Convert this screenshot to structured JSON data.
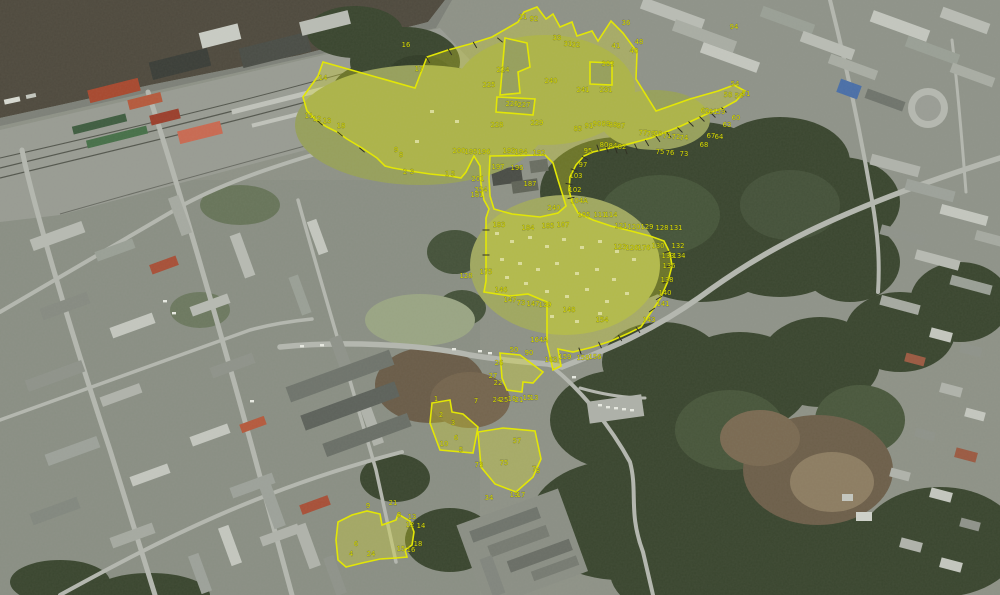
{
  "map": {
    "description": "aerial-cadastral-overlay",
    "colors": {
      "boundary_line": "#e4e800",
      "boundary_fill": "rgba(225,228,30,0.30)",
      "parcel_label": "#d9dd00",
      "river": "#4f4a3e",
      "forest": "#3a462f",
      "urban_base": "#8e9287",
      "road": "#b4b7af",
      "railway_band": "#999c93"
    },
    "parcel_labels": [
      {
        "t": "14",
        "x": 323,
        "y": 80
      },
      {
        "t": "16",
        "x": 406,
        "y": 47
      },
      {
        "t": "17",
        "x": 419,
        "y": 71
      },
      {
        "t": "11",
        "x": 309,
        "y": 118
      },
      {
        "t": "12",
        "x": 317,
        "y": 121
      },
      {
        "t": "13",
        "x": 327,
        "y": 123
      },
      {
        "t": "18",
        "x": 341,
        "y": 128
      },
      {
        "t": "9",
        "x": 396,
        "y": 152
      },
      {
        "t": "8",
        "x": 401,
        "y": 157
      },
      {
        "t": "2",
        "x": 405,
        "y": 174
      },
      {
        "t": "3",
        "x": 412,
        "y": 174
      },
      {
        "t": "1",
        "x": 447,
        "y": 176
      },
      {
        "t": "5",
        "x": 453,
        "y": 176
      },
      {
        "t": "21",
        "x": 523,
        "y": 19
      },
      {
        "t": "92",
        "x": 534,
        "y": 21
      },
      {
        "t": "224",
        "x": 503,
        "y": 72
      },
      {
        "t": "225",
        "x": 489,
        "y": 87
      },
      {
        "t": "226",
        "x": 512,
        "y": 106
      },
      {
        "t": "227",
        "x": 524,
        "y": 107
      },
      {
        "t": "228",
        "x": 497,
        "y": 127
      },
      {
        "t": "229",
        "x": 537,
        "y": 125
      },
      {
        "t": "240",
        "x": 551,
        "y": 83
      },
      {
        "t": "241",
        "x": 583,
        "y": 92
      },
      {
        "t": "231",
        "x": 606,
        "y": 92
      },
      {
        "t": "302",
        "x": 608,
        "y": 66
      },
      {
        "t": "33",
        "x": 557,
        "y": 40
      },
      {
        "t": "31",
        "x": 568,
        "y": 46
      },
      {
        "t": "32",
        "x": 576,
        "y": 47
      },
      {
        "t": "41",
        "x": 616,
        "y": 48
      },
      {
        "t": "40",
        "x": 634,
        "y": 53
      },
      {
        "t": "48",
        "x": 639,
        "y": 44
      },
      {
        "t": "36",
        "x": 626,
        "y": 25
      },
      {
        "t": "94",
        "x": 734,
        "y": 29
      },
      {
        "t": "85",
        "x": 578,
        "y": 131
      },
      {
        "t": "91",
        "x": 589,
        "y": 128
      },
      {
        "t": "90",
        "x": 597,
        "y": 126
      },
      {
        "t": "89",
        "x": 606,
        "y": 126
      },
      {
        "t": "88",
        "x": 613,
        "y": 127
      },
      {
        "t": "87",
        "x": 621,
        "y": 128
      },
      {
        "t": "80",
        "x": 604,
        "y": 147
      },
      {
        "t": "84",
        "x": 613,
        "y": 148
      },
      {
        "t": "82",
        "x": 622,
        "y": 149
      },
      {
        "t": "95",
        "x": 588,
        "y": 153
      },
      {
        "t": "77",
        "x": 643,
        "y": 135
      },
      {
        "t": "79",
        "x": 651,
        "y": 136
      },
      {
        "t": "78",
        "x": 658,
        "y": 136
      },
      {
        "t": "75",
        "x": 660,
        "y": 154
      },
      {
        "t": "76",
        "x": 670,
        "y": 155
      },
      {
        "t": "73",
        "x": 684,
        "y": 156
      },
      {
        "t": "71",
        "x": 667,
        "y": 138
      },
      {
        "t": "72",
        "x": 676,
        "y": 139
      },
      {
        "t": "74",
        "x": 684,
        "y": 140
      },
      {
        "t": "68",
        "x": 704,
        "y": 147
      },
      {
        "t": "67",
        "x": 711,
        "y": 138
      },
      {
        "t": "64",
        "x": 719,
        "y": 139
      },
      {
        "t": "63",
        "x": 727,
        "y": 127
      },
      {
        "t": "60",
        "x": 736,
        "y": 120
      },
      {
        "t": "59",
        "x": 721,
        "y": 114
      },
      {
        "t": "61",
        "x": 713,
        "y": 114
      },
      {
        "t": "62",
        "x": 705,
        "y": 113
      },
      {
        "t": "58",
        "x": 728,
        "y": 97
      },
      {
        "t": "56",
        "x": 739,
        "y": 98
      },
      {
        "t": "54",
        "x": 735,
        "y": 86
      },
      {
        "t": "51",
        "x": 746,
        "y": 96
      },
      {
        "t": "97",
        "x": 583,
        "y": 167
      },
      {
        "t": "103",
        "x": 576,
        "y": 178
      },
      {
        "t": "102",
        "x": 575,
        "y": 192
      },
      {
        "t": "104A",
        "x": 579,
        "y": 203
      },
      {
        "t": "105",
        "x": 584,
        "y": 217
      },
      {
        "t": "111",
        "x": 600,
        "y": 217
      },
      {
        "t": "114",
        "x": 611,
        "y": 217
      },
      {
        "t": "121",
        "x": 621,
        "y": 228
      },
      {
        "t": "120",
        "x": 634,
        "y": 229
      },
      {
        "t": "129",
        "x": 647,
        "y": 229
      },
      {
        "t": "128",
        "x": 662,
        "y": 230
      },
      {
        "t": "131",
        "x": 676,
        "y": 230
      },
      {
        "t": "123",
        "x": 620,
        "y": 249
      },
      {
        "t": "126",
        "x": 632,
        "y": 250
      },
      {
        "t": "176",
        "x": 644,
        "y": 250
      },
      {
        "t": "130",
        "x": 658,
        "y": 248
      },
      {
        "t": "132",
        "x": 678,
        "y": 248
      },
      {
        "t": "133",
        "x": 668,
        "y": 258
      },
      {
        "t": "134",
        "x": 679,
        "y": 258
      },
      {
        "t": "136",
        "x": 669,
        "y": 268
      },
      {
        "t": "138",
        "x": 667,
        "y": 282
      },
      {
        "t": "140",
        "x": 665,
        "y": 295
      },
      {
        "t": "141",
        "x": 663,
        "y": 306
      },
      {
        "t": "143",
        "x": 649,
        "y": 322
      },
      {
        "t": "154",
        "x": 602,
        "y": 322
      },
      {
        "t": "181",
        "x": 477,
        "y": 197
      },
      {
        "t": "183",
        "x": 499,
        "y": 227
      },
      {
        "t": "184",
        "x": 528,
        "y": 230
      },
      {
        "t": "185",
        "x": 548,
        "y": 228
      },
      {
        "t": "187",
        "x": 530,
        "y": 186
      },
      {
        "t": "240",
        "x": 554,
        "y": 210
      },
      {
        "t": "200",
        "x": 459,
        "y": 153
      },
      {
        "t": "195",
        "x": 471,
        "y": 154
      },
      {
        "t": "196",
        "x": 484,
        "y": 154
      },
      {
        "t": "193",
        "x": 509,
        "y": 153
      },
      {
        "t": "194",
        "x": 521,
        "y": 154
      },
      {
        "t": "192",
        "x": 539,
        "y": 155
      },
      {
        "t": "197",
        "x": 498,
        "y": 169
      },
      {
        "t": "196",
        "x": 517,
        "y": 170
      },
      {
        "t": "201",
        "x": 478,
        "y": 181
      },
      {
        "t": "254",
        "x": 481,
        "y": 192
      },
      {
        "t": "175",
        "x": 486,
        "y": 274
      },
      {
        "t": "128",
        "x": 466,
        "y": 278
      },
      {
        "t": "146",
        "x": 501,
        "y": 292
      },
      {
        "t": "147",
        "x": 510,
        "y": 302
      },
      {
        "t": "73",
        "x": 521,
        "y": 305
      },
      {
        "t": "147",
        "x": 533,
        "y": 306
      },
      {
        "t": "139",
        "x": 545,
        "y": 307
      },
      {
        "t": "148",
        "x": 569,
        "y": 312
      },
      {
        "t": "107",
        "x": 563,
        "y": 227
      },
      {
        "t": "164A",
        "x": 539,
        "y": 342
      },
      {
        "t": "50",
        "x": 514,
        "y": 352
      },
      {
        "t": "90",
        "x": 529,
        "y": 355
      },
      {
        "t": "163",
        "x": 551,
        "y": 362
      },
      {
        "t": "159",
        "x": 565,
        "y": 359
      },
      {
        "t": "158",
        "x": 583,
        "y": 360
      },
      {
        "t": "156",
        "x": 595,
        "y": 359
      },
      {
        "t": "26",
        "x": 499,
        "y": 365
      },
      {
        "t": "27",
        "x": 493,
        "y": 378
      },
      {
        "t": "22",
        "x": 498,
        "y": 385
      },
      {
        "t": "24",
        "x": 497,
        "y": 402
      },
      {
        "t": "25",
        "x": 504,
        "y": 402
      },
      {
        "t": "18",
        "x": 512,
        "y": 401
      },
      {
        "t": "21",
        "x": 519,
        "y": 402
      },
      {
        "t": "15",
        "x": 527,
        "y": 400
      },
      {
        "t": "13",
        "x": 534,
        "y": 400
      },
      {
        "t": "7",
        "x": 476,
        "y": 403
      },
      {
        "t": "1",
        "x": 436,
        "y": 401
      },
      {
        "t": "2",
        "x": 441,
        "y": 417
      },
      {
        "t": "3",
        "x": 453,
        "y": 425
      },
      {
        "t": "6",
        "x": 456,
        "y": 440
      },
      {
        "t": "10",
        "x": 444,
        "y": 446
      },
      {
        "t": "5",
        "x": 461,
        "y": 452
      },
      {
        "t": "57",
        "x": 517,
        "y": 443
      },
      {
        "t": "75",
        "x": 504,
        "y": 465
      },
      {
        "t": "73",
        "x": 479,
        "y": 467
      },
      {
        "t": "7",
        "x": 534,
        "y": 471
      },
      {
        "t": "8",
        "x": 538,
        "y": 473
      },
      {
        "t": "19",
        "x": 514,
        "y": 497
      },
      {
        "t": "17",
        "x": 521,
        "y": 497
      },
      {
        "t": "34",
        "x": 489,
        "y": 500
      },
      {
        "t": "21",
        "x": 393,
        "y": 505
      },
      {
        "t": "9",
        "x": 368,
        "y": 508
      },
      {
        "t": "8",
        "x": 399,
        "y": 517
      },
      {
        "t": "13",
        "x": 412,
        "y": 519
      },
      {
        "t": "12",
        "x": 410,
        "y": 527
      },
      {
        "t": "14",
        "x": 421,
        "y": 528
      },
      {
        "t": "15",
        "x": 401,
        "y": 551
      },
      {
        "t": "16",
        "x": 411,
        "y": 552
      },
      {
        "t": "18",
        "x": 418,
        "y": 546
      },
      {
        "t": "24",
        "x": 371,
        "y": 556
      },
      {
        "t": "4",
        "x": 351,
        "y": 556
      },
      {
        "t": "6",
        "x": 356,
        "y": 546
      }
    ]
  }
}
